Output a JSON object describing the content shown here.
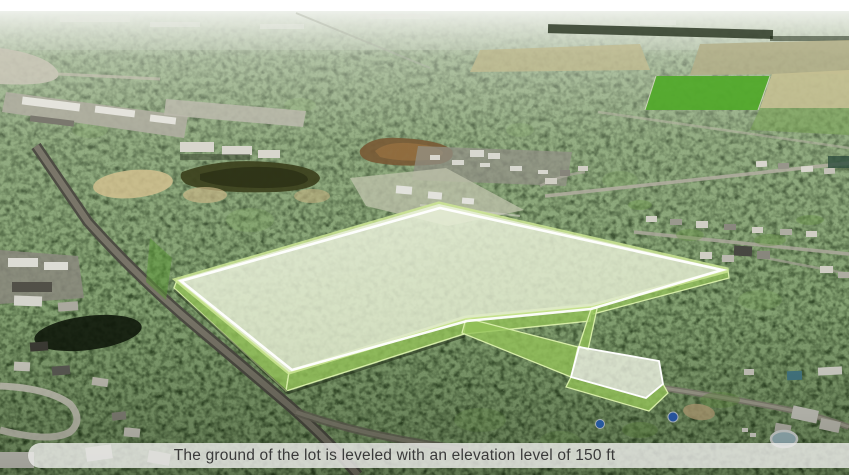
{
  "caption": {
    "text": "The ground of the lot is leveled with an elevation level of 150 ft"
  },
  "map": {
    "view": "aerial-3d-tilted",
    "lot": {
      "label": "Highlighted lot boundary",
      "elevation_ft": 150,
      "fill_color": "#e3ecd0",
      "flag_fill_color": "#eff3e4",
      "wall_color": "#94c259",
      "edge_color": "#cde694",
      "border_color": "#ffffff"
    }
  }
}
